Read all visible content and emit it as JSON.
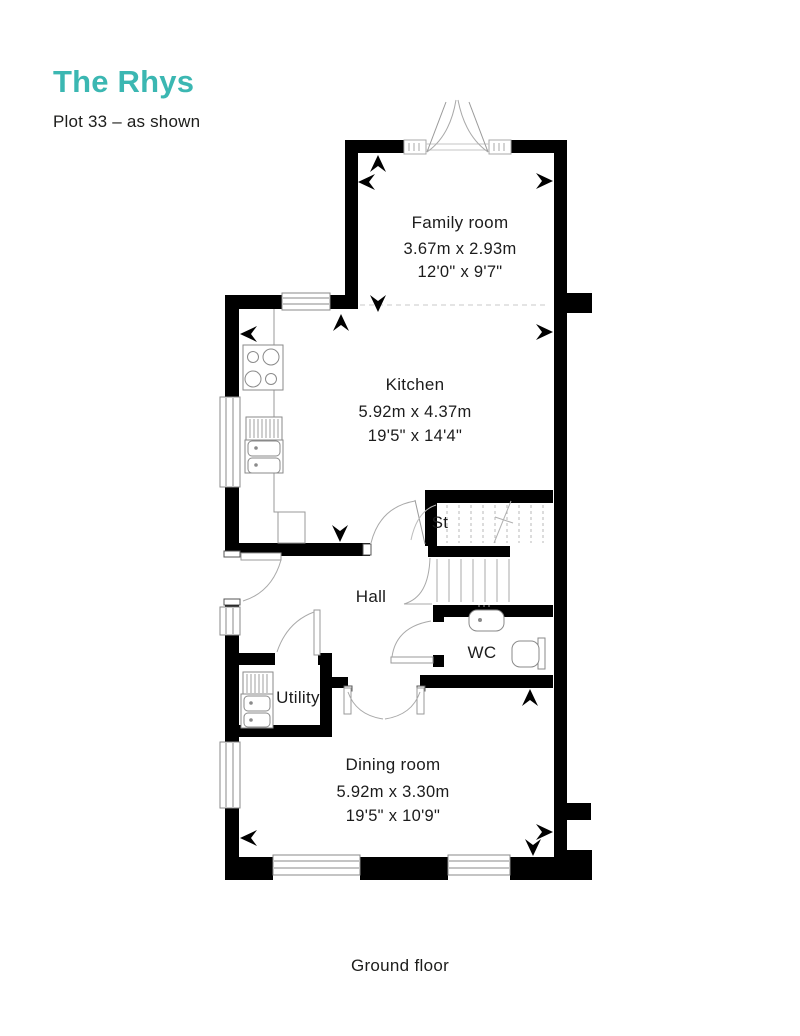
{
  "header": {
    "title": "The Rhys",
    "subtitle": "Plot 33 – as shown"
  },
  "plan": {
    "rooms": {
      "family": {
        "name": "Family room",
        "metric": "3.67m x 2.93m",
        "imperial": "12'0\" x 9'7\""
      },
      "kitchen": {
        "name": "Kitchen",
        "metric": "5.92m x 4.37m",
        "imperial": "19'5\" x 14'4\""
      },
      "dining": {
        "name": "Dining room",
        "metric": "5.92m x 3.30m",
        "imperial": "19'5\" x 10'9\""
      },
      "hall": {
        "name": "Hall"
      },
      "wc": {
        "name": "WC"
      },
      "utility": {
        "name": "Utility"
      },
      "store": {
        "name": "St"
      }
    }
  },
  "footer": {
    "label": "Ground floor"
  },
  "colors": {
    "accent": "#3BB7B2",
    "text": "#1d1d1b",
    "wall": "#000000",
    "thin_line": "#9a9a9a"
  }
}
